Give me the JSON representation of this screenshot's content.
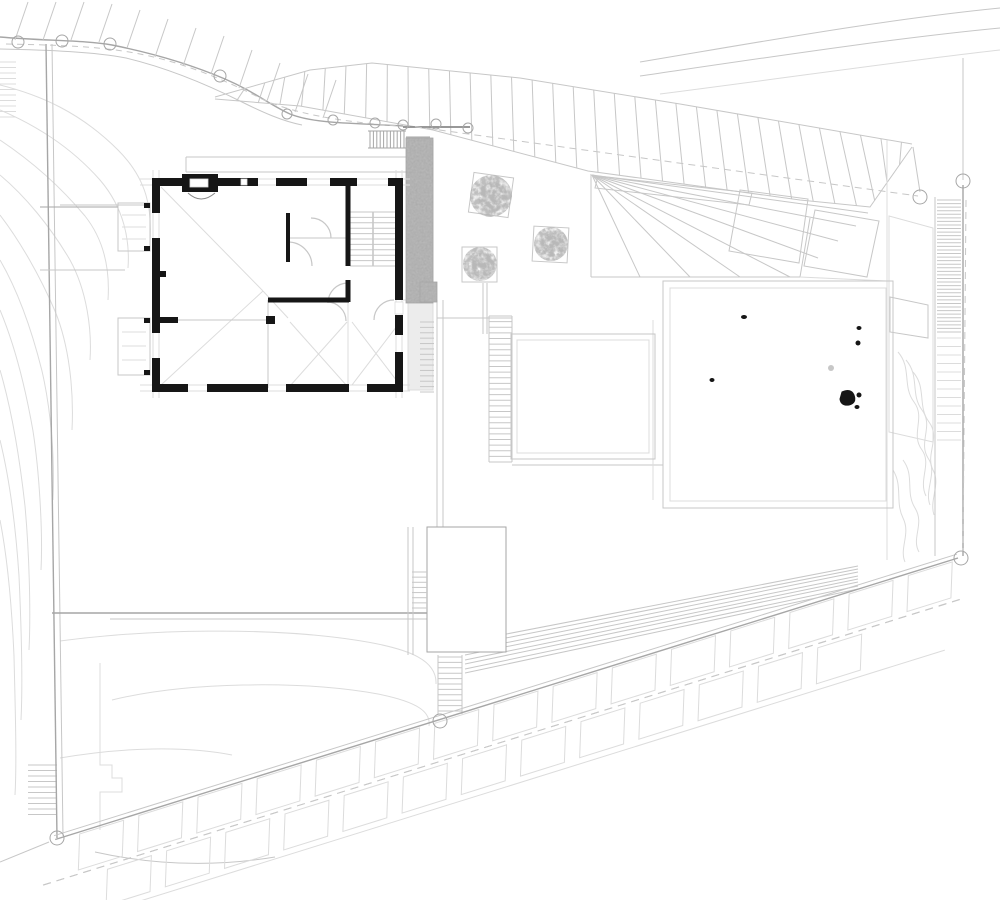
{
  "meta": {
    "sheet_type": "architectural-site-plan",
    "canvas_w": 1000,
    "canvas_h": 900,
    "background": "#ffffff"
  },
  "palette": {
    "faint": "#dcdcdc",
    "light": "#c7c7c7",
    "mid": "#a6a6a6",
    "dark": "#8a8a8a",
    "ink": "#161616",
    "concrete": "#b7b7b7",
    "tree": "#8f8f8f",
    "white": "#ffffff",
    "strip": "#ececec"
  },
  "lines": [
    [
      46,
      44,
      57,
      838,
      "mid",
      1.4
    ],
    [
      52,
      44,
      63,
      836,
      "light",
      1
    ],
    [
      186,
      157,
      406,
      157,
      "light",
      1
    ],
    [
      186,
      172,
      406,
      172,
      "light",
      1
    ],
    [
      186,
      157,
      186,
      172,
      "light",
      1
    ],
    [
      60,
      205,
      150,
      205,
      "light",
      1
    ],
    [
      40,
      207,
      118,
      207,
      "mid",
      1
    ],
    [
      40,
      270,
      125,
      270,
      "light",
      1
    ],
    [
      52,
      613,
      427,
      613,
      "mid",
      1.4
    ],
    [
      110,
      619,
      427,
      619,
      "light",
      1
    ],
    [
      403,
      127,
      470,
      127,
      "dark",
      1.8
    ],
    [
      406,
      137,
      430,
      137,
      "mid",
      1
    ],
    [
      368,
      131,
      406,
      131,
      "mid",
      1
    ],
    [
      368,
      148,
      406,
      148,
      "mid",
      1
    ],
    [
      433,
      140,
      433,
      300,
      "light",
      1
    ],
    [
      437,
      300,
      437,
      527,
      "light",
      1
    ],
    [
      443,
      300,
      443,
      527,
      "light",
      1
    ],
    [
      483,
      283,
      483,
      334,
      "light",
      1
    ],
    [
      487,
      283,
      487,
      334,
      "light",
      1
    ],
    [
      437,
      318,
      512,
      318,
      "light",
      1
    ],
    [
      403,
      300,
      437,
      300,
      "faint",
      1
    ],
    [
      489,
      316,
      489,
      462,
      "light",
      1
    ],
    [
      512,
      316,
      512,
      462,
      "light",
      1
    ],
    [
      512,
      465,
      663,
      465,
      "light",
      1
    ],
    [
      591,
      174,
      591,
      277,
      "light",
      1
    ],
    [
      591,
      277,
      800,
      277,
      "light",
      1
    ],
    [
      800,
      277,
      810,
      218,
      "light",
      1
    ],
    [
      800,
      277,
      887,
      281,
      "faint",
      1
    ],
    [
      408,
      527,
      408,
      655,
      "light",
      1
    ],
    [
      413,
      527,
      413,
      655,
      "light",
      1
    ],
    [
      438,
      655,
      438,
      714,
      "light",
      1
    ],
    [
      462,
      655,
      462,
      714,
      "light",
      1
    ],
    [
      887,
      140,
      887,
      560,
      "faint",
      1
    ],
    [
      935,
      197,
      935,
      556,
      "light",
      1
    ],
    [
      963,
      185,
      963,
      556,
      "mid",
      1.4
    ],
    [
      963,
      58,
      963,
      180,
      "light",
      1
    ],
    [
      913,
      147,
      920,
      192,
      "light",
      1
    ],
    [
      653,
      320,
      653,
      500,
      "faint",
      1
    ],
    [
      0,
      862,
      49,
      842,
      "light",
      1
    ],
    [
      465,
      642,
      858,
      566,
      "light",
      1
    ],
    [
      465,
      646,
      858,
      569,
      "light",
      1
    ],
    [
      465,
      651,
      858,
      572,
      "light",
      1
    ],
    [
      465,
      655,
      858,
      576,
      "light",
      1
    ],
    [
      465,
      660,
      858,
      579,
      "light",
      1
    ],
    [
      465,
      664,
      858,
      582,
      "light",
      1
    ],
    [
      465,
      669,
      858,
      586,
      "light",
      1
    ],
    [
      465,
      673,
      858,
      589,
      "light",
      1
    ],
    [
      161,
      187,
      263,
      291,
      "faint",
      1
    ],
    [
      161,
      385,
      263,
      291,
      "faint",
      1
    ],
    [
      263,
      291,
      288,
      318,
      "faint",
      1
    ],
    [
      290,
      322,
      347,
      386,
      "faint",
      1
    ],
    [
      347,
      322,
      290,
      386,
      "faint",
      1
    ],
    [
      352,
      322,
      400,
      385,
      "faint",
      1
    ],
    [
      400,
      322,
      352,
      385,
      "faint",
      1
    ],
    [
      288,
      238,
      348,
      238,
      "light",
      1
    ],
    [
      268,
      300,
      268,
      388,
      "light",
      1
    ],
    [
      178,
      320,
      268,
      320,
      "light",
      1
    ],
    [
      348,
      302,
      348,
      388,
      "faint",
      1
    ],
    [
      373,
      212,
      373,
      266,
      "mid",
      1
    ],
    [
      122,
      215,
      146,
      215,
      "faint",
      1
    ],
    [
      122,
      227,
      146,
      227,
      "faint",
      1
    ],
    [
      122,
      239,
      146,
      239,
      "faint",
      1
    ],
    [
      122,
      332,
      146,
      332,
      "faint",
      1
    ],
    [
      122,
      346,
      146,
      346,
      "faint",
      1
    ],
    [
      122,
      360,
      146,
      360,
      "faint",
      1
    ]
  ],
  "dashed": [
    [
      403,
      125,
      918,
      196,
      "light",
      1,
      "7 5"
    ],
    [
      966,
      200,
      963,
      552,
      "light",
      1,
      "7 5"
    ],
    [
      43,
      885,
      965,
      598,
      "light",
      1,
      "8 6"
    ]
  ],
  "paths": [
    {
      "d": "M0 37 C 45 41 85 40 112 45 C 152 53 190 64 225 79 C 255 92 270 105 290 114 C 315 124 355 123 403 126",
      "c": "mid",
      "w": 1.4
    },
    {
      "d": "M0 49 C 50 50 95 52 126 58 C 168 68 208 85 242 102 C 262 112 282 121 302 125",
      "c": "light",
      "w": 1
    },
    {
      "d": "M6 44 C 55 45 100 46 140 54 C 185 63 225 80 262 99 C 292 113 340 122 400 126",
      "c": "light",
      "w": 1,
      "dash": "6 5"
    },
    {
      "d": "M640 62 C 760 42 880 20 1000 8",
      "c": "light",
      "w": 1
    },
    {
      "d": "M640 76 C 770 57 895 38 1000 28",
      "c": "light",
      "w": 1
    },
    {
      "d": "M660 94 C 800 76 910 60 1000 50",
      "c": "faint",
      "w": 1
    },
    {
      "d": "M95 852 Q185 872 275 857",
      "c": "light",
      "w": 1
    },
    {
      "d": "M100 663 L100 765 L112 765 L112 778 L122 778 L122 792 L100 792 L100 830",
      "c": "faint",
      "w": 1
    },
    {
      "d": "M60 641 C 150 629 270 627 355 640 C 415 649 437 662 436 684",
      "c": "faint",
      "w": 1
    },
    {
      "d": "M112 700 C 185 682 300 680 378 694 C 418 702 431 712 429 726",
      "c": "faint",
      "w": 1
    },
    {
      "d": "M60 758 C 125 747 185 746 232 755",
      "c": "faint",
      "w": 1
    },
    {
      "d": "M0 85 C 40 95 80 112 118 150 C 148 180 152 210 150 242",
      "c": "faint",
      "w": 1
    },
    {
      "d": "M0 110 C 35 125 70 146 100 180 C 124 208 130 240 128 268",
      "c": "faint",
      "w": 1
    },
    {
      "d": "M0 140 C 30 160 60 186 85 216 C 104 240 110 270 108 300",
      "c": "faint",
      "w": 1
    },
    {
      "d": "M0 175 C 25 196 50 226 70 260 C 87 291 92 330 90 360",
      "c": "faint",
      "w": 1
    },
    {
      "d": "M0 215 C 20 241 40 276 55 311 C 69 345 74 390 72 430",
      "c": "faint",
      "w": 1
    },
    {
      "d": "M0 260 C 18 291 32 331 42 371 C 51 410 55 460 53 500",
      "c": "faint",
      "w": 1
    },
    {
      "d": "M0 310 C 15 346 26 391 33 431 C 39 470 43 530 41 570",
      "c": "faint",
      "w": 1
    },
    {
      "d": "M0 370 C 12 411 20 461 25 506 C 29 550 31 610 29 650",
      "c": "faint",
      "w": 1
    },
    {
      "d": "M0 440 C 10 481 16 531 19 576 C 21 620 23 680 21 720",
      "c": "faint",
      "w": 1
    },
    {
      "d": "M0 520 C 8 561 12 611 14 656 C 15 700 17 760 15 795",
      "c": "faint",
      "w": 1
    },
    {
      "d": "M898 352 C 912 368 902 386 914 402 C 926 418 910 434 922 450 C 932 464 918 480 926 496",
      "c": "faint",
      "w": 1
    },
    {
      "d": "M906 360 C 920 376 910 394 922 410 C 934 426 918 442 928 458 C 938 472 924 490 930 505",
      "c": "faint",
      "w": 1
    },
    {
      "d": "M913 372 C 927 388 917 406 929 422 C 941 438 925 454 933 470 C 941 484 929 500 934 515",
      "c": "faint",
      "w": 1
    },
    {
      "d": "M903 460 C 915 476 905 492 915 508 C 925 524 911 538 919 552",
      "c": "faint",
      "w": 1
    },
    {
      "d": "M893 470 C 903 486 895 502 903 518 C 911 534 899 548 905 562",
      "c": "faint",
      "w": 1
    },
    {
      "d": "M598 176 L752 193 L749 205 L595 188 Z",
      "c": "light",
      "w": 1
    },
    {
      "d": "M740 190 L808 199 L799 263 L729 251 Z",
      "c": "light",
      "w": 1
    },
    {
      "d": "M815 210 L879 221 L867 277 L804 266 Z",
      "c": "light",
      "w": 1
    },
    {
      "d": "M889 216 L933 228 L933 442 L889 432 Z",
      "c": "faint",
      "w": 1
    },
    {
      "d": "M890 297 L928 305 L928 338 L890 332 Z",
      "c": "light",
      "w": 1
    },
    {
      "d": "M188 193 Q201 205 215 193",
      "c": "dark",
      "w": 1
    },
    {
      "d": "M288 242 A24 24 0 0 1 312 266",
      "c": "light",
      "w": 1.2
    },
    {
      "d": "M331 238 A20 20 0 0 0 311 218",
      "c": "light",
      "w": 1.2
    },
    {
      "d": "M348 283 A20 20 0 0 0 328 303",
      "c": "light",
      "w": 1.2
    },
    {
      "d": "M394 300 A20 20 0 0 0 374 320",
      "c": "light",
      "w": 1.2
    },
    {
      "d": "M327 302 A19 19 0 0 1 346 321",
      "c": "light",
      "w": 1.2
    }
  ],
  "ticks": {
    "slope_top": {
      "bases": [
        [
          15,
          40
        ],
        [
          43,
          40
        ],
        [
          71,
          40
        ],
        [
          99,
          42
        ],
        [
          127,
          48
        ],
        [
          155,
          57
        ],
        [
          183,
          66
        ],
        [
          211,
          74
        ],
        [
          239,
          88
        ],
        [
          267,
          101
        ],
        [
          295,
          112
        ],
        [
          323,
          118
        ]
      ],
      "dx": 13,
      "dy": -38,
      "c": "light",
      "w": 1
    },
    "left_edge": {
      "x1": 0,
      "x2": 16,
      "y0": 62,
      "step": 5.5,
      "n": 11,
      "c": "faint",
      "w": 1
    },
    "west_lower": {
      "x1": 28,
      "x2": 57,
      "y0": 765,
      "step": 5.5,
      "n": 10,
      "c": "light",
      "w": 1
    }
  },
  "circles": [
    [
      18,
      42,
      6
    ],
    [
      62,
      41,
      6
    ],
    [
      110,
      44,
      6
    ],
    [
      220,
      76,
      6
    ],
    [
      287,
      114,
      5
    ],
    [
      333,
      120,
      5
    ],
    [
      375,
      123,
      5
    ],
    [
      403,
      125,
      5
    ],
    [
      436,
      124,
      5
    ],
    [
      468,
      128,
      5
    ],
    [
      920,
      197,
      7
    ],
    [
      963,
      181,
      7
    ],
    [
      961,
      558,
      7
    ],
    [
      57,
      838,
      7
    ],
    [
      440,
      721,
      7
    ]
  ],
  "road_band": {
    "top": [
      [
        215,
        97
      ],
      [
        310,
        70
      ],
      [
        372,
        63
      ],
      [
        520,
        78
      ],
      [
        680,
        104
      ],
      [
        912,
        144
      ]
    ],
    "bottom": [
      [
        215,
        99
      ],
      [
        300,
        106
      ],
      [
        433,
        130
      ],
      [
        588,
        171
      ],
      [
        800,
        200
      ],
      [
        870,
        207
      ],
      [
        912,
        147
      ]
    ],
    "hatch_n": 34,
    "lean": 10,
    "c": "light",
    "w": 1
  },
  "fan": {
    "apex": [
      592,
      175
    ],
    "ends": [
      [
        640,
        277
      ],
      [
        690,
        277
      ],
      [
        740,
        277
      ],
      [
        790,
        277
      ],
      [
        818,
        258
      ],
      [
        838,
        241
      ],
      [
        856,
        226
      ],
      [
        868,
        213
      ]
    ],
    "c": "light",
    "w": 1
  },
  "stairs": [
    {
      "o": "h",
      "x1": 350,
      "x2": 396,
      "y1": 212,
      "y2": 266,
      "n": 11,
      "c": "light",
      "w": 1
    },
    {
      "o": "v",
      "x1": 370,
      "x2": 404,
      "y1": 131,
      "y2": 148,
      "n": 11,
      "c": "mid",
      "w": 1
    },
    {
      "o": "h",
      "x1": 420,
      "x2": 434,
      "y1": 322,
      "y2": 392,
      "n": 14,
      "c": "light",
      "w": 1
    },
    {
      "o": "h",
      "x1": 489,
      "x2": 512,
      "y1": 316,
      "y2": 462,
      "n": 27,
      "c": "light",
      "w": 1
    },
    {
      "o": "h",
      "x1": 412,
      "x2": 427,
      "y1": 572,
      "y2": 608,
      "n": 8,
      "c": "light",
      "w": 1
    },
    {
      "o": "h",
      "x1": 438,
      "x2": 462,
      "y1": 657,
      "y2": 711,
      "n": 11,
      "c": "light",
      "w": 1
    },
    {
      "o": "h",
      "x1": 937,
      "x2": 961,
      "y1": 200,
      "y2": 332,
      "n": 38,
      "c": "light",
      "w": 1
    },
    {
      "o": "h",
      "x1": 937,
      "x2": 961,
      "y1": 338,
      "y2": 440,
      "n": 13,
      "c": "faint",
      "w": 1
    }
  ],
  "rects": [
    {
      "x": 511,
      "y": 334,
      "w": 144,
      "h": 125,
      "stroke": "light"
    },
    {
      "x": 517,
      "y": 340,
      "w": 132,
      "h": 113,
      "stroke": "faint"
    },
    {
      "x": 663,
      "y": 281,
      "w": 230,
      "h": 227,
      "stroke": "light"
    },
    {
      "x": 670,
      "y": 288,
      "w": 216,
      "h": 213,
      "stroke": "faint"
    },
    {
      "x": 427,
      "y": 527,
      "w": 79,
      "h": 125,
      "stroke": "mid",
      "fill": "white"
    },
    {
      "x": 408,
      "y": 295,
      "w": 25,
      "h": 95,
      "stroke": "faint",
      "fill": "strip"
    },
    {
      "x": 118,
      "y": 203,
      "w": 32,
      "h": 48,
      "stroke": "light"
    },
    {
      "x": 118,
      "y": 318,
      "w": 32,
      "h": 57,
      "stroke": "light"
    }
  ],
  "concrete": [
    {
      "x": 406,
      "y": 138,
      "w": 27,
      "h": 165
    },
    {
      "x": 420,
      "y": 282,
      "w": 17,
      "h": 20
    }
  ],
  "house": {
    "wall_w": 8,
    "top": {
      "c": 182,
      "from": 140,
      "to": 410,
      "segs": [
        [
          152,
          258
        ],
        [
          276,
          307
        ],
        [
          330,
          357
        ],
        [
          388,
          403
        ]
      ]
    },
    "bottom": {
      "c": 388,
      "from": 140,
      "to": 410,
      "segs": [
        [
          152,
          188
        ],
        [
          207,
          268
        ],
        [
          286,
          349
        ],
        [
          367,
          403
        ]
      ]
    },
    "left": {
      "c": 156,
      "from": 170,
      "to": 398,
      "segs": [
        [
          178,
          213
        ],
        [
          238,
          333
        ],
        [
          358,
          392
        ]
      ]
    },
    "right": {
      "c": 399,
      "from": 170,
      "to": 398,
      "segs": [
        [
          178,
          300
        ],
        [
          315,
          335
        ],
        [
          352,
          392
        ]
      ]
    },
    "interior": [
      {
        "o": "v",
        "c": 348,
        "w": 5,
        "seg": [
          183,
          266
        ]
      },
      {
        "o": "v",
        "c": 348,
        "w": 5,
        "seg": [
          280,
          302
        ]
      },
      {
        "o": "h",
        "c": 300,
        "w": 5,
        "seg": [
          268,
          349
        ]
      },
      {
        "o": "v",
        "c": 288,
        "w": 4,
        "seg": [
          213,
          262
        ]
      },
      {
        "o": "h",
        "c": 320,
        "w": 6,
        "seg": [
          152,
          178
        ]
      }
    ],
    "black_rects": [
      [
        182,
        174,
        36,
        18
      ],
      [
        266,
        316,
        9,
        8
      ],
      [
        158,
        271,
        8,
        6
      ],
      [
        144,
        203,
        6,
        5
      ],
      [
        144,
        246,
        6,
        5
      ],
      [
        144,
        318,
        6,
        5
      ],
      [
        144,
        370,
        6,
        5
      ]
    ],
    "white_rects": [
      [
        190,
        179,
        18,
        8
      ],
      [
        241,
        179,
        6,
        6
      ],
      [
        395,
        302,
        8,
        12
      ]
    ]
  },
  "trees": [
    {
      "cx": 491,
      "cy": 196,
      "r": 21,
      "sq": [
        471,
        175,
        40,
        40,
        8
      ]
    },
    {
      "cx": 551,
      "cy": 244,
      "r": 17,
      "sq": [
        533,
        227,
        35,
        35,
        3
      ]
    },
    {
      "cx": 480,
      "cy": 264,
      "r": 17,
      "sq": [
        462,
        247,
        35,
        35,
        0
      ]
    }
  ],
  "pool_dots": [
    {
      "t": "e",
      "x": 744,
      "y": 317,
      "rx": 3,
      "ry": 2
    },
    {
      "t": "e",
      "x": 859,
      "y": 328,
      "rx": 2.5,
      "ry": 2
    },
    {
      "t": "e",
      "x": 858,
      "y": 343,
      "rx": 2.5,
      "ry": 2.5
    },
    {
      "t": "e",
      "x": 712,
      "y": 380,
      "rx": 2.5,
      "ry": 2
    },
    {
      "t": "p",
      "d": "M842 392 q9 -4 12 3 q3 8 -5 10 q-8 1 -9 -6 z"
    },
    {
      "t": "e",
      "x": 859,
      "y": 395,
      "rx": 2.5,
      "ry": 2.5
    },
    {
      "t": "e",
      "x": 857,
      "y": 407,
      "rx": 2.5,
      "ry": 2
    },
    {
      "t": "g",
      "x": 831,
      "y": 368,
      "rx": 3,
      "ry": 3
    }
  ],
  "slope_band": {
    "p0": [
      60,
      838
    ],
    "p1": [
      958,
      558
    ],
    "rows": [
      {
        "o1": 2,
        "o2": 36,
        "n": 15,
        "step": 62,
        "off": 8,
        "tilt": 12
      },
      {
        "o1": 44,
        "o2": 78,
        "n": 13,
        "step": 62,
        "off": 24,
        "tilt": 12
      }
    ],
    "dash_o": 40,
    "lower_o": 84,
    "c": "faint"
  }
}
